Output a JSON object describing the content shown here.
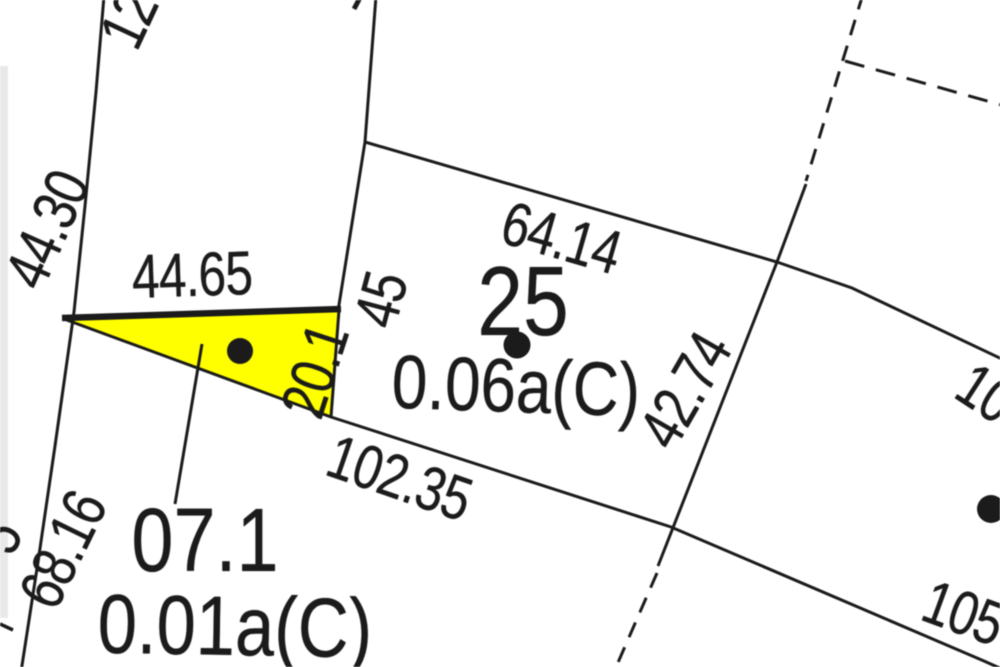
{
  "colors": {
    "background": "#ffffff",
    "ink": "#1b1b1b",
    "highlight": "#ffff00",
    "scan_edge": "#e9e9e9"
  },
  "parcels": {
    "highlighted": {
      "number": "07.1",
      "area": "0.01a(C)"
    },
    "center": {
      "number": "25",
      "area": "0.06a(C)"
    }
  },
  "dimensions": {
    "left_road_upper": "44.30",
    "left_road_lower": "68.16",
    "top_parcel_partial": "12",
    "top_edge_partial": "1",
    "frontage": "44.65",
    "west_side": "45",
    "highlight_east_side": "20.1",
    "parcel25_north": "64.14",
    "parcel25_east": "42.74",
    "parcel25_south": "102.35",
    "east_parcel_north_partial": "10",
    "east_parcel_south_partial": "105",
    "left_edge_partial": "5"
  }
}
